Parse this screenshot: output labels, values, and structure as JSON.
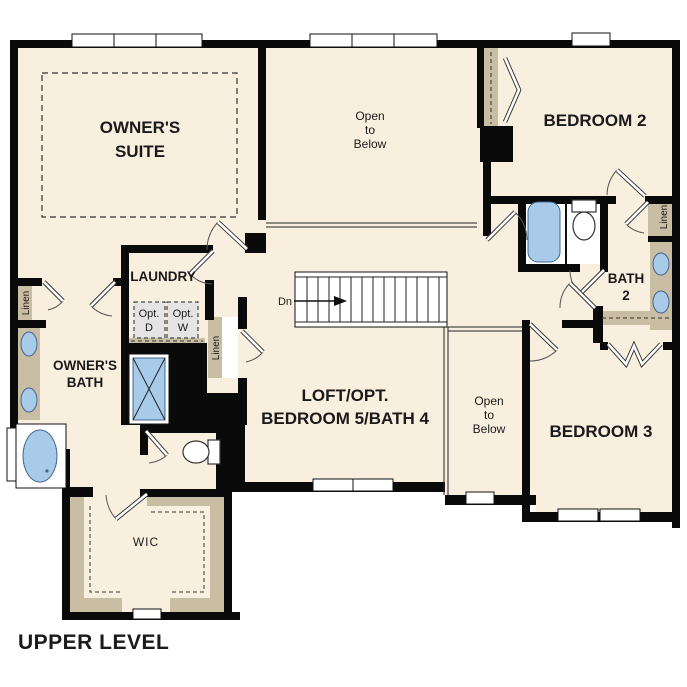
{
  "title": {
    "footer": "UPPER LEVEL"
  },
  "colors": {
    "page_bg": "#ffffff",
    "floor": "#f8efdf",
    "wall": "#0a0a0a",
    "tan": "#c9bda3",
    "fixture_blue": "#a9cbea",
    "fixture_stroke": "#40648c",
    "appliance_gray": "#e4e4e4",
    "text": "#1a1a1a"
  },
  "rooms": {
    "owners_suite": {
      "line1": "OWNER'S",
      "line2": "SUITE"
    },
    "open_below_1": {
      "line1": "Open",
      "line2": "to",
      "line3": "Below"
    },
    "bedroom2": {
      "label": "BEDROOM 2"
    },
    "bath2": {
      "line1": "BATH",
      "line2": "2"
    },
    "bedroom3": {
      "label": "BEDROOM 3"
    },
    "loft": {
      "line1": "LOFT/OPT.",
      "line2": "BEDROOM 5/BATH 4"
    },
    "open_below_2": {
      "line1": "Open",
      "line2": "to",
      "line3": "Below"
    },
    "laundry": {
      "label": "LAUNDRY"
    },
    "owners_bath": {
      "line1": "OWNER'S",
      "line2": "BATH"
    },
    "wic": {
      "label": "WIC"
    }
  },
  "fixtures": {
    "opt_dryer": {
      "line1": "Opt.",
      "line2": "D"
    },
    "opt_washer": {
      "line1": "Opt.",
      "line2": "W"
    },
    "linen_owner": "Linen",
    "linen_hall": "Linen",
    "linen_bath2": "Linen",
    "stairs_down": "Dn"
  }
}
